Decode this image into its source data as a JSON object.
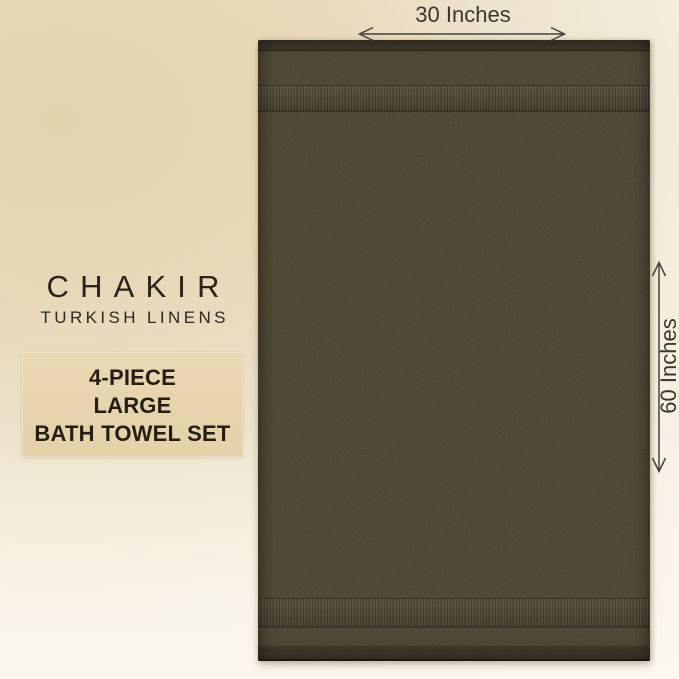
{
  "brand": {
    "name": "CHAKIR",
    "subtitle": "TURKISH LINENS"
  },
  "product": {
    "lines": [
      "4-PIECE",
      "LARGE",
      "BATH TOWEL SET"
    ]
  },
  "dimensions": {
    "width_label": "30 Inches",
    "height_label": "60 Inches"
  },
  "colors": {
    "towel": "#4c4432",
    "towel_band": "#453e2e",
    "towel_hem": "#3f3827",
    "background_beige": "#e4d5b0",
    "background_cream": "#f7f1e5",
    "info_box_bg": "#e6d4ae",
    "brand_text": "#2a241b",
    "product_text": "#241e15",
    "annotation_text": "#3c372d",
    "arrow": "#45403c"
  }
}
